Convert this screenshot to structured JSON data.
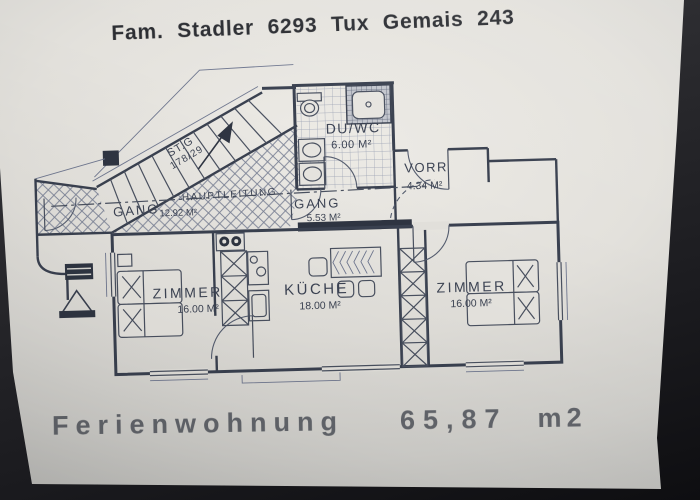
{
  "photo": {
    "title": "Fam. Stadler 6293 Tux Gemais 243",
    "footer": {
      "label": "Ferienwohnung",
      "area_value": "65,87",
      "area_unit": "m2"
    }
  },
  "plan": {
    "rooms": {
      "bathroom": {
        "name": "DU/WC",
        "area": "6.00 M²"
      },
      "vestibule": {
        "name": "VORR",
        "area": "4.34 M²"
      },
      "hall_main": {
        "name": "GANG",
        "area": "12.92 M²"
      },
      "hall_small": {
        "name": "GANG",
        "area": "5.53 M²"
      },
      "bedroom_left": {
        "name": "ZIMMER",
        "area": "16.00 M²"
      },
      "kitchen": {
        "name": "KÜCHE",
        "area": "18.00 M²"
      },
      "bedroom_right": {
        "name": "ZIMMER",
        "area": "16.00 M²"
      }
    },
    "labels": {
      "main_line": "HAUPTLEITUNG",
      "stair_line1": "ST.G",
      "stair_line2": "178/29"
    },
    "colors": {
      "ink": "#4a5160",
      "wall": "#2f3542",
      "paper": "#e7e5e0"
    }
  }
}
